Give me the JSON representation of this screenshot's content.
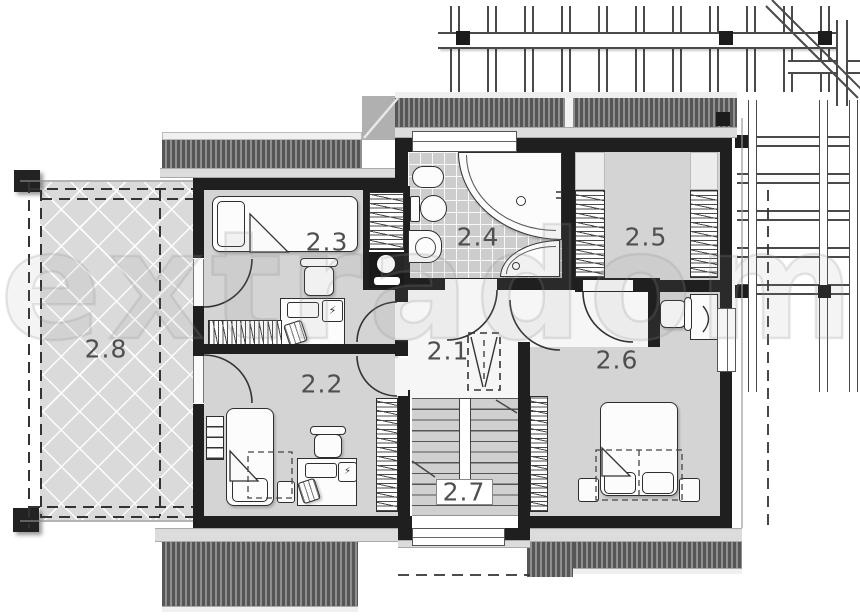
{
  "plan": {
    "type": "architectural-floor-plan-upper-storey",
    "rooms": [
      {
        "label": "2.1",
        "kind": "hall",
        "symbols": [
          "void-shaft-symbol"
        ]
      },
      {
        "label": "2.2",
        "kind": "bedroom",
        "symbols": [
          "single-bed",
          "pillow",
          "shelf",
          "nightstand",
          "desk",
          "computer",
          "office-chair",
          "waste-bin",
          "wardrobe"
        ]
      },
      {
        "label": "2.3",
        "kind": "bedroom",
        "symbols": [
          "single-bed",
          "pillow",
          "desk",
          "computer",
          "office-chair",
          "waste-bin",
          "wardrobe",
          "laundry-closet",
          "washing-machine"
        ]
      },
      {
        "label": "2.4",
        "kind": "bathroom",
        "symbols": [
          "corner-bathtub",
          "shower",
          "toilet",
          "bidet",
          "washbasin"
        ]
      },
      {
        "label": "2.5",
        "kind": "dressing-room",
        "symbols": [
          "wardrobe-left",
          "wardrobe-right"
        ]
      },
      {
        "label": "2.6",
        "kind": "bedroom",
        "symbols": [
          "double-bed",
          "pillows",
          "nightstand-left",
          "nightstand-right",
          "desk",
          "office-chair",
          "wardrobe"
        ]
      },
      {
        "label": "2.7",
        "kind": "staircase",
        "symbols": [
          "stairs",
          "handrail"
        ]
      },
      {
        "label": "2.8",
        "kind": "terrace",
        "symbols": [
          "cross-hatch-deck",
          "posts"
        ]
      }
    ],
    "colors": {
      "wall": "#1f1f1f",
      "room_fill": "#d4d4d4",
      "hall_fill": "#f6f6f6",
      "terrace_fill": "#dadada",
      "bath_tile": "#cdcdcd",
      "roof_dark": "#5e5e5e"
    },
    "watermark": "extradom"
  }
}
